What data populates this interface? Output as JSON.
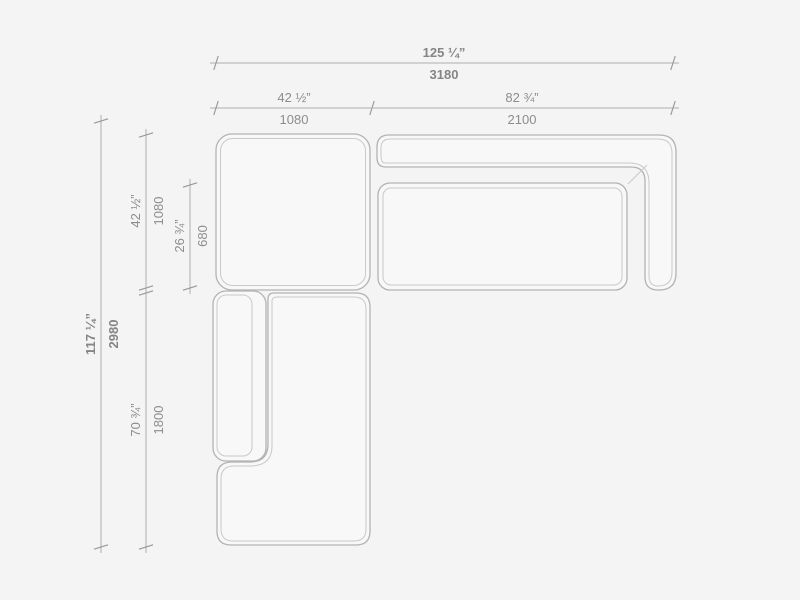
{
  "drawing": {
    "name": "sectional-sofa-top-view-dimension-drawing",
    "colors": {
      "background": "#f4f4f4",
      "module_fill": "#f8f8f8",
      "outline": "#b3b3b3",
      "inner_line": "#c9c9c9",
      "dimension_line": "#aeaeae",
      "text": "#8d8d8d"
    },
    "dimensions": {
      "overall_width": {
        "inches": "125 ¼”",
        "mm": "3180"
      },
      "ottoman_width": {
        "inches": "42 ½”",
        "mm": "1080"
      },
      "sofa_width": {
        "inches": "82 ¾”",
        "mm": "2100"
      },
      "overall_depth": {
        "inches": "117 ¼”",
        "mm": "2980"
      },
      "ottoman_depth": {
        "inches": "42 ½”",
        "mm": "1080"
      },
      "seat_depth": {
        "inches": "26 ¾”",
        "mm": "680"
      },
      "chaise_depth": {
        "inches": "70 ¾”",
        "mm": "1800"
      }
    }
  }
}
